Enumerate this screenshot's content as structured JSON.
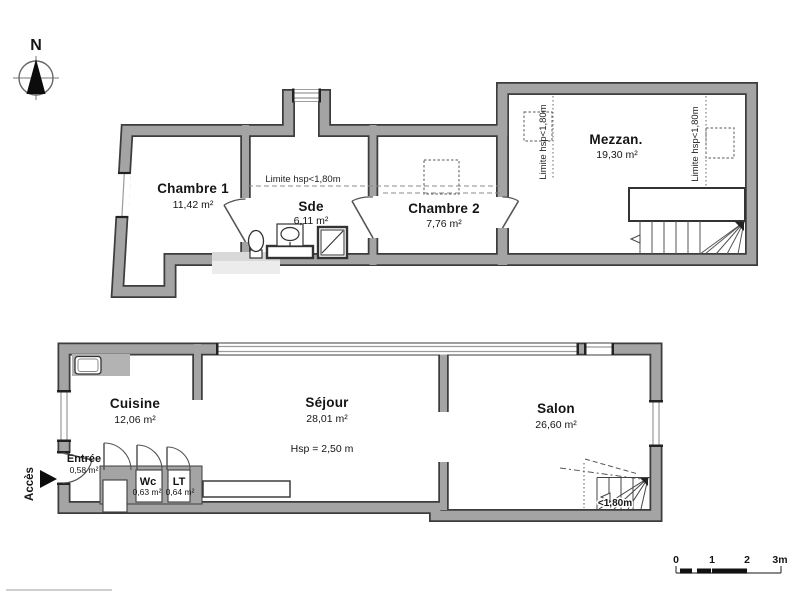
{
  "compass": {
    "north_label": "N"
  },
  "access": {
    "label": "Accès"
  },
  "upper_floor": {
    "rooms": {
      "chambre1": {
        "name": "Chambre 1",
        "area": "11,42 m²"
      },
      "sde": {
        "name": "Sde",
        "area": "6,11 m²"
      },
      "chambre2": {
        "name": "Chambre 2",
        "area": "7,76 m²"
      },
      "mezzanine": {
        "name": "Mezzan.",
        "area": "19,30 m²"
      }
    },
    "annotations": {
      "limite_h": "Limite hsp<1,80m",
      "limite_v_left": "Limite hsp<1,80m",
      "limite_v_right": "Limite hsp<1,80m"
    }
  },
  "lower_floor": {
    "rooms": {
      "cuisine": {
        "name": "Cuisine",
        "area": "12,06 m²"
      },
      "sejour": {
        "name": "Séjour",
        "area": "28,01 m²",
        "ceiling_note": "Hsp = 2,50 m"
      },
      "salon": {
        "name": "Salon",
        "area": "26,60 m²"
      },
      "entree": {
        "name": "Entrée",
        "area": "0,58 m²"
      },
      "wc": {
        "name": "Wc",
        "area": "0,63 m²"
      },
      "lt": {
        "name": "LT",
        "area": "0,64 m²"
      }
    },
    "annotations": {
      "stair_height": "<1,80m"
    }
  },
  "scale_bar": {
    "t0": "0",
    "t1": "1",
    "t2": "2",
    "t3": "3m"
  },
  "colors": {
    "wall_fill": "#a4a4a4",
    "wall_edge": "#3d3d3d",
    "low_ceiling_wall": "#d9d9d9"
  }
}
